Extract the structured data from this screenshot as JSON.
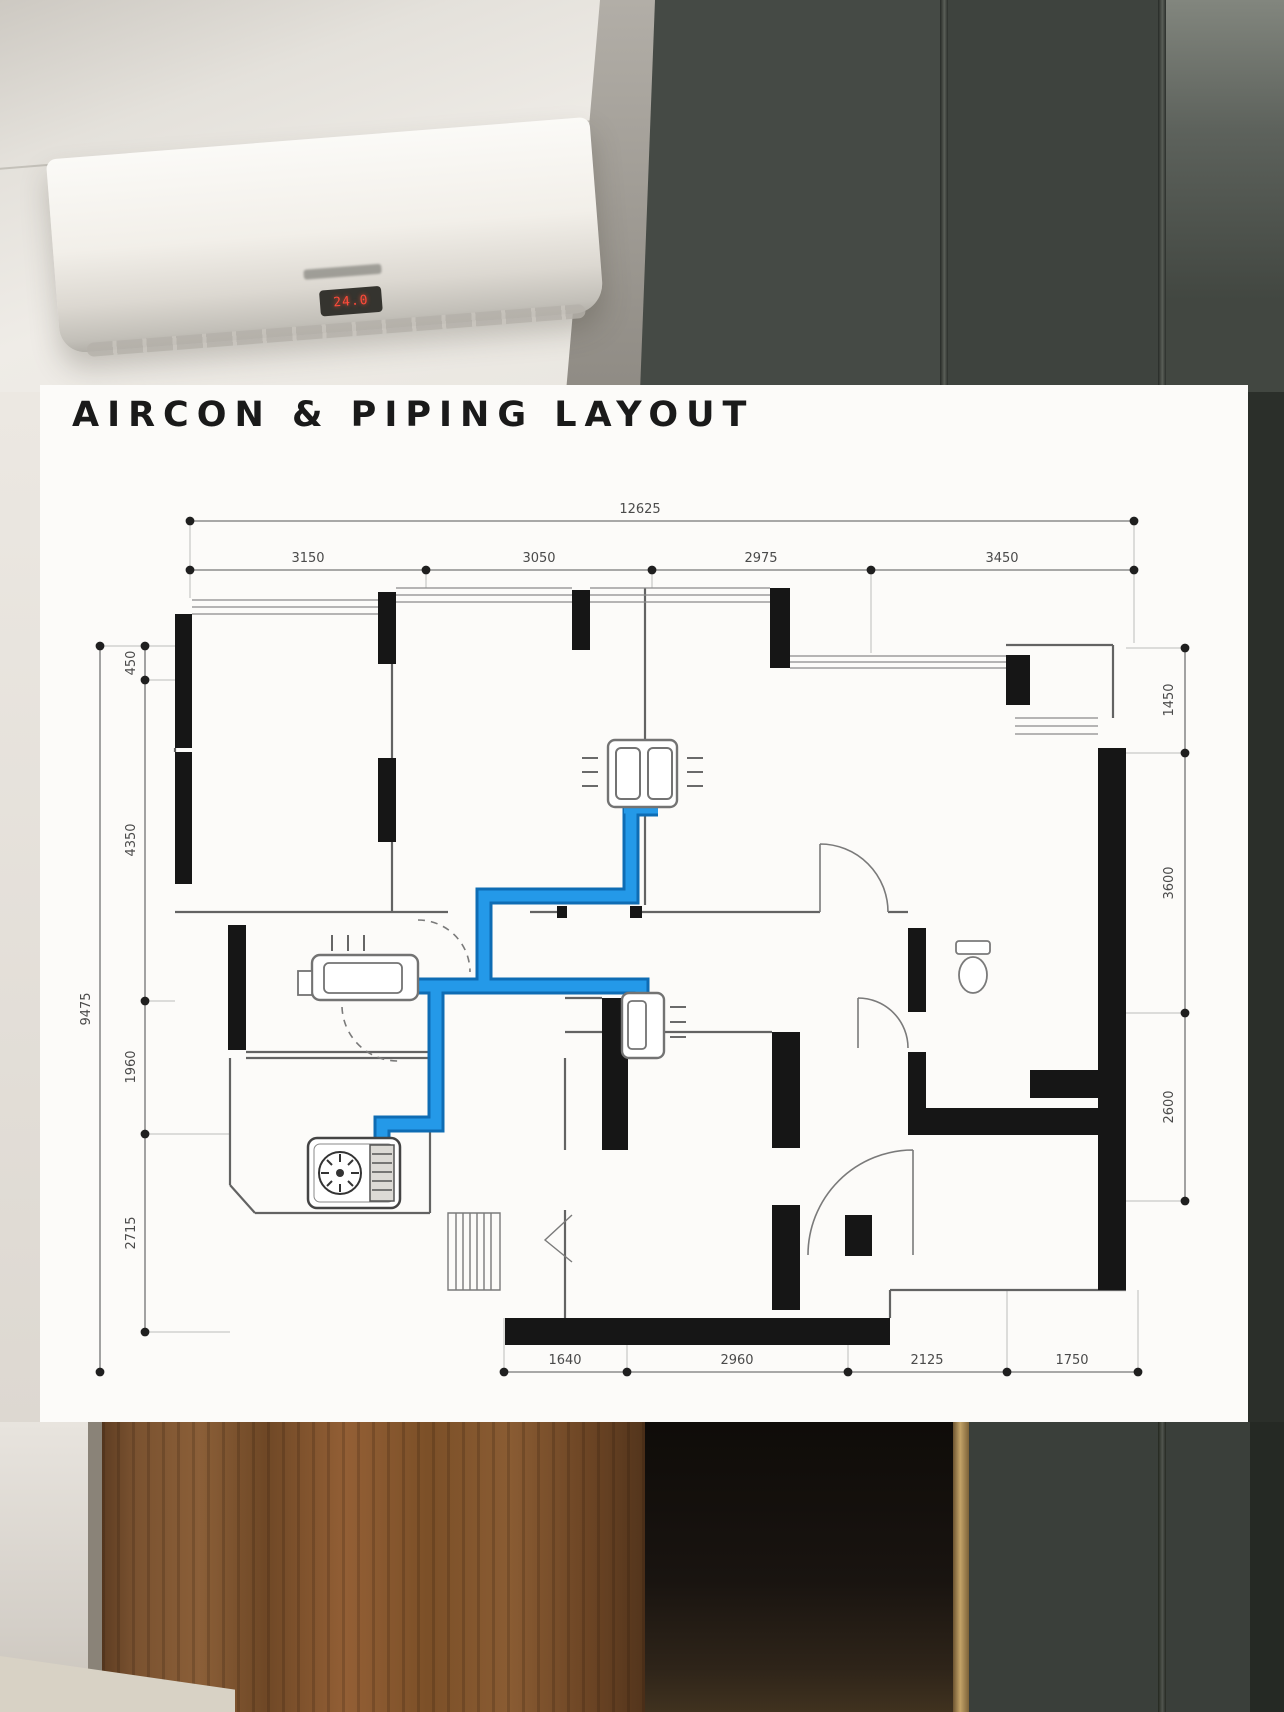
{
  "title": "AIRCON & PIPING LAYOUT",
  "photo": {
    "ac_display": "24.0"
  },
  "dimensions": {
    "top_total": "12625",
    "top_segments": [
      "3150",
      "3050",
      "2975",
      "3450"
    ],
    "left_total": "9475",
    "left_segments": [
      "450",
      "4350",
      "1960",
      "2715"
    ],
    "right_segments": [
      "1450",
      "3600",
      "2600"
    ],
    "bottom_segments": [
      "1640",
      "2960",
      "2125",
      "1750"
    ]
  },
  "colors": {
    "pipe": "#2499e8",
    "pipe_dark": "#0e6cb4",
    "wall": "#161616",
    "dim_line": "#8c8c8c",
    "dim_text": "#4a4a4a"
  }
}
